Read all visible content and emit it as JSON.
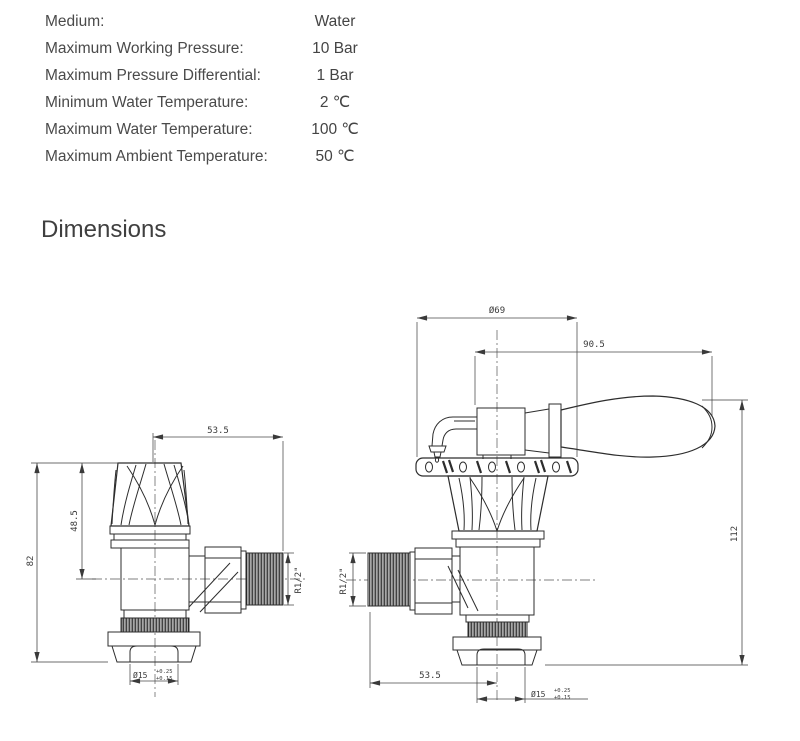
{
  "specs": {
    "rows": [
      {
        "label": "Medium:",
        "value": "Water"
      },
      {
        "label": "Maximum Working Pressure:",
        "value": "10 Bar"
      },
      {
        "label": "Maximum Pressure Differential:",
        "value": "1 Bar"
      },
      {
        "label": "Minimum Water Temperature:",
        "value": "2 ℃"
      },
      {
        "label": "Maximum Water Temperature:",
        "value": "100 ℃"
      },
      {
        "label": "Maximum Ambient Temperature:",
        "value": "50 ℃"
      }
    ]
  },
  "section": {
    "title": "Dimensions"
  },
  "drawing": {
    "line_color": "#2d2d2d",
    "dim_color": "#3a3a3a",
    "left_valve": {
      "top_width": "53.5",
      "overall_height": "82",
      "head_height": "48.5",
      "thread_size": "R1/2\"",
      "tail_diameter": "Ø15",
      "tail_tol_upper": "+0.25",
      "tail_tol_lower": "+0.15"
    },
    "right_valve": {
      "flange_diameter": "Ø69",
      "handle_length": "90.5",
      "overall_height": "112",
      "bottom_width": "53.5",
      "thread_size": "R1/2\"",
      "tail_diameter": "Ø15",
      "tail_tol_upper": "+0.25",
      "tail_tol_lower": "+0.15"
    }
  }
}
